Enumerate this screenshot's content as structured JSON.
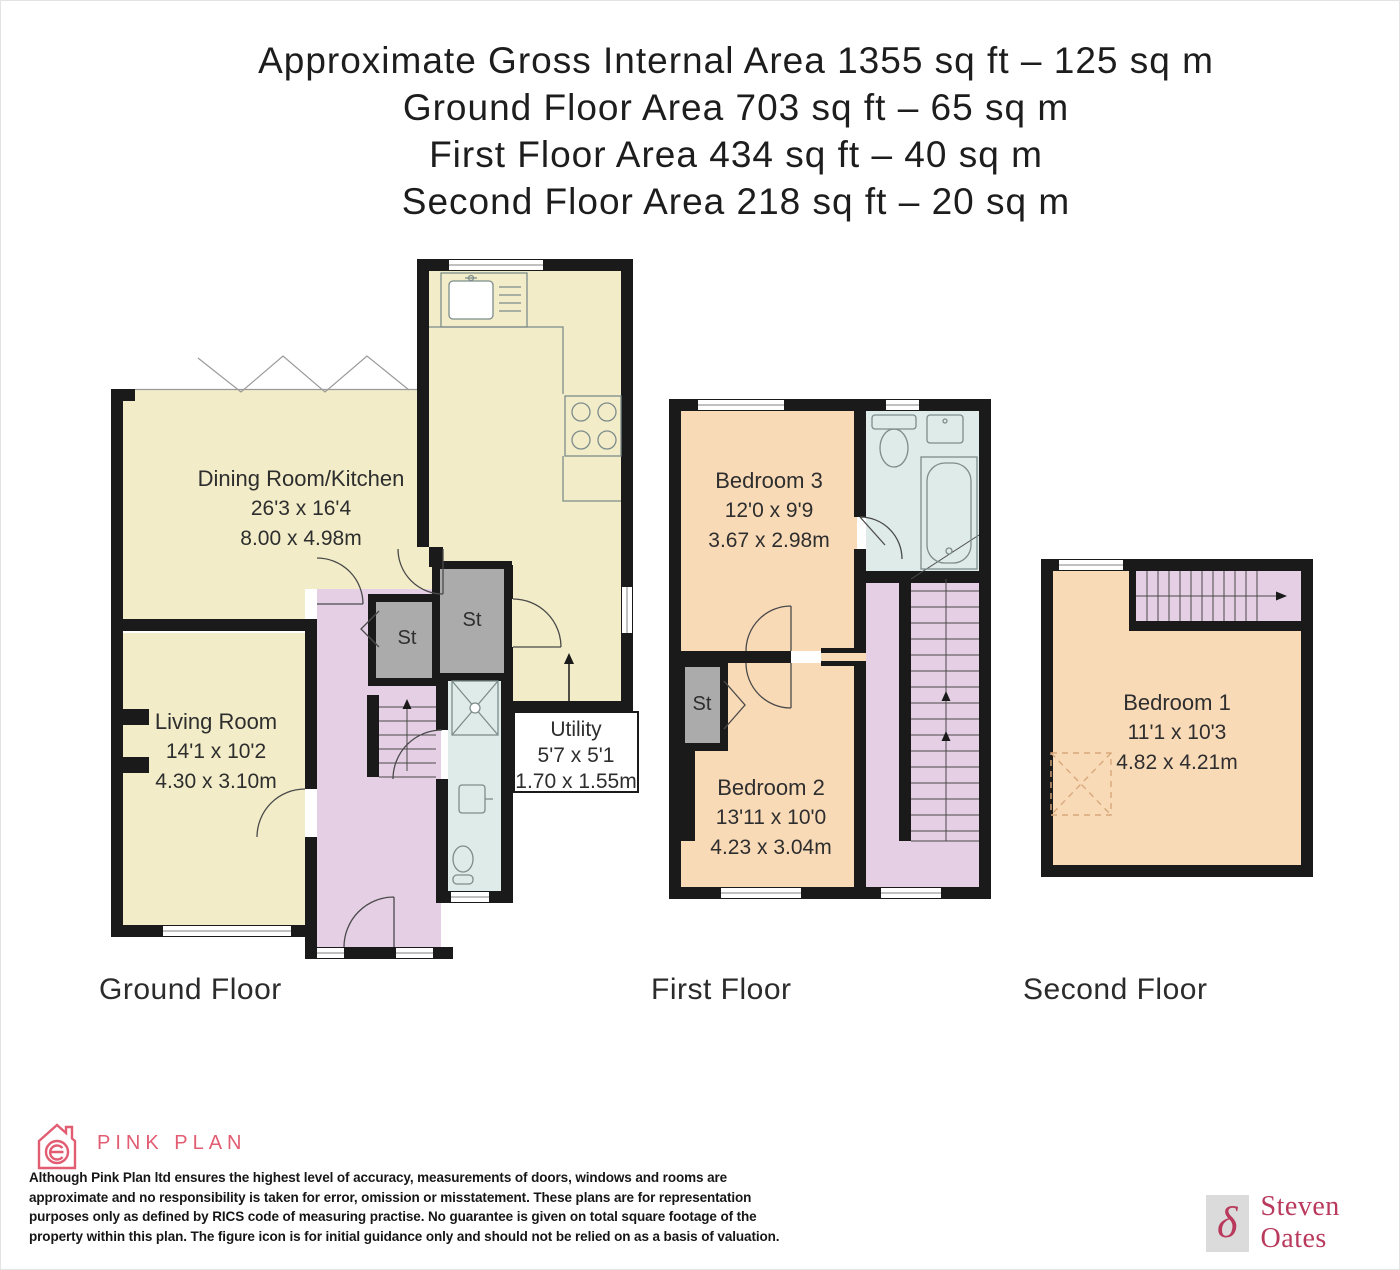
{
  "title": {
    "lines": [
      "Approximate Gross Internal Area 1355 sq ft – 125 sq m",
      "Ground Floor Area 703 sq ft – 65 sq m",
      "First Floor Area 434 sq ft – 40 sq m",
      "Second Floor Area 218 sq ft – 20 sq m"
    ]
  },
  "floors": {
    "ground": {
      "label": "Ground Floor",
      "dining": {
        "name": "Dining Room/Kitchen",
        "imperial": "26'3 x 16'4",
        "metric": "8.00 x 4.98m"
      },
      "living": {
        "name": "Living Room",
        "imperial": "14'1 x 10'2",
        "metric": "4.30 x 3.10m"
      },
      "utility": {
        "name": "Utility",
        "imperial": "5'7 x 5'1",
        "metric": "1.70 x 1.55m"
      },
      "store1": "St",
      "store2": "St"
    },
    "first": {
      "label": "First Floor",
      "bedroom3": {
        "name": "Bedroom 3",
        "imperial": "12'0 x 9'9",
        "metric": "3.67 x 2.98m"
      },
      "bedroom2": {
        "name": "Bedroom 2",
        "imperial": "13'11 x 10'0",
        "metric": "4.23 x 3.04m"
      },
      "store": "St"
    },
    "second": {
      "label": "Second Floor",
      "bedroom1": {
        "name": "Bedroom 1",
        "imperial": "11'1 x 10'3",
        "metric": "4.82 x 4.21m"
      }
    }
  },
  "footer": {
    "brand": "PINK PLAN",
    "disclaimer_lines": [
      "Although Pink Plan ltd ensures the highest level of accuracy, measurements of doors, windows and rooms are",
      "approximate and no responsibility is taken for error, omission or misstatement. These plans are for representation",
      "purposes only as defined by RICS code of measuring practise. No guarantee is given on total square footage of the",
      "property within this plan. The figure icon is for initial guidance only and should not be relied on as a basis of valuation."
    ],
    "agent": "Steven Oates",
    "agent_glyph": "δ"
  },
  "colors": {
    "walls": "#1a1a1a",
    "cream": "#f2edc8",
    "peach": "#f9dab7",
    "lavender": "#e5cfe4",
    "blue": "#dfebe8",
    "grey": "#ababab",
    "pink": "#e25c72",
    "crimson": "#b93a5c"
  }
}
